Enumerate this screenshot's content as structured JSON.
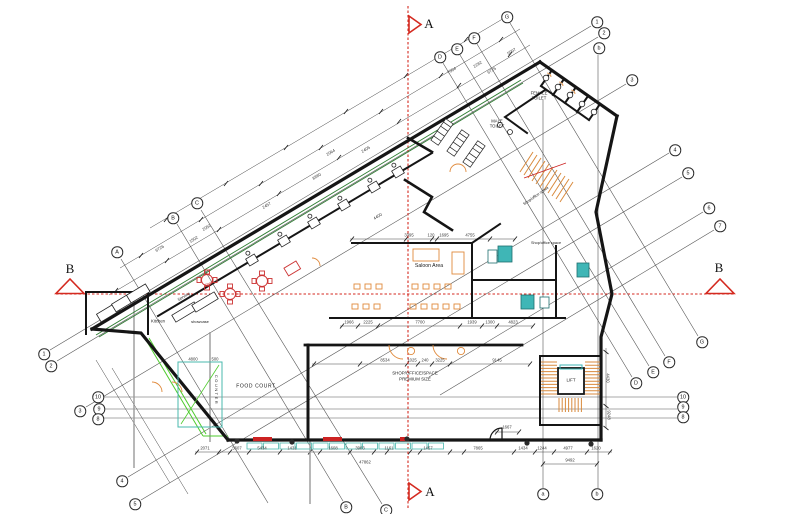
{
  "title": "architectural-floor-plan",
  "colors": {
    "section_red": "#d42a20",
    "glazing_green": "#2e7d32",
    "bright_green": "#4ecb2d",
    "counter_teal": "#4ab8ae",
    "teal_fixture": "#3fb6b6",
    "furniture_orange": "#e08a3c",
    "furniture_red": "#cc3333",
    "wall_black": "#151515"
  },
  "drawing": {
    "section_markers": [
      {
        "label": "A",
        "x": 429,
        "y": 24,
        "size": 13
      },
      {
        "label": "A",
        "x": 430,
        "y": 492,
        "size": 13
      },
      {
        "label": "B",
        "x": 70,
        "y": 269,
        "size": 13
      },
      {
        "label": "B",
        "x": 719,
        "y": 268,
        "size": 13
      }
    ],
    "bubbles": [
      {
        "label": "A",
        "x": 117,
        "y": 252
      },
      {
        "label": "B",
        "x": 173,
        "y": 218
      },
      {
        "label": "C",
        "x": 197,
        "y": 203
      },
      {
        "label": "D",
        "x": 440,
        "y": 57
      },
      {
        "label": "E",
        "x": 457,
        "y": 49
      },
      {
        "label": "F",
        "x": 474,
        "y": 38
      },
      {
        "label": "G",
        "x": 507,
        "y": 17
      },
      {
        "label": "1",
        "x": 597,
        "y": 22
      },
      {
        "label": "2",
        "x": 604,
        "y": 33
      },
      {
        "label": "b",
        "x": 599,
        "y": 48
      },
      {
        "label": "3",
        "x": 632,
        "y": 80
      },
      {
        "label": "4",
        "x": 675,
        "y": 150
      },
      {
        "label": "5",
        "x": 688,
        "y": 173
      },
      {
        "label": "6",
        "x": 709,
        "y": 208
      },
      {
        "label": "7",
        "x": 720,
        "y": 226
      },
      {
        "label": "D",
        "x": 636,
        "y": 383
      },
      {
        "label": "E",
        "x": 653,
        "y": 372
      },
      {
        "label": "F",
        "x": 669,
        "y": 362
      },
      {
        "label": "G",
        "x": 702,
        "y": 342
      },
      {
        "label": "10",
        "x": 683,
        "y": 397
      },
      {
        "label": "9",
        "x": 683,
        "y": 407
      },
      {
        "label": "8",
        "x": 683,
        "y": 417
      },
      {
        "label": "1",
        "x": 44,
        "y": 354
      },
      {
        "label": "2",
        "x": 51,
        "y": 366
      },
      {
        "label": "3",
        "x": 80,
        "y": 411
      },
      {
        "label": "10",
        "x": 98,
        "y": 397
      },
      {
        "label": "9",
        "x": 99,
        "y": 409
      },
      {
        "label": "8",
        "x": 98,
        "y": 419
      },
      {
        "label": "4",
        "x": 122,
        "y": 481
      },
      {
        "label": "5",
        "x": 135,
        "y": 504
      },
      {
        "label": "B",
        "x": 346,
        "y": 507
      },
      {
        "label": "C",
        "x": 386,
        "y": 510
      },
      {
        "label": "a",
        "x": 543,
        "y": 494
      },
      {
        "label": "b",
        "x": 597,
        "y": 494
      }
    ],
    "room_labels": [
      {
        "text": "FEMALE\nTOILET",
        "x": 539,
        "y": 96,
        "size": 4.2
      },
      {
        "text": "MALE\nTOILET",
        "x": 497,
        "y": 124,
        "size": 4.2
      },
      {
        "text": "Saloon Area",
        "x": 429,
        "y": 267,
        "size": 5.2
      },
      {
        "text": "Kitchen",
        "x": 158,
        "y": 322,
        "size": 4.2
      },
      {
        "text": "showcase",
        "x": 200,
        "y": 322,
        "size": 4
      },
      {
        "text": "Serving",
        "x": 184,
        "y": 297,
        "size": 4,
        "rot": -31
      },
      {
        "text": "Shop",
        "x": 209,
        "y": 284,
        "size": 4,
        "rot": -31,
        "color": "#cc3333"
      },
      {
        "text": "FOOD COURT",
        "x": 256,
        "y": 387,
        "size": 5,
        "ls": 0.6
      },
      {
        "text": "SHOP/OFFICE/SPACE",
        "x": 415,
        "y": 374,
        "size": 4.4
      },
      {
        "text": "PREMIUM SIZE",
        "x": 415,
        "y": 380,
        "size": 4.4
      },
      {
        "text": "LIFT",
        "x": 571,
        "y": 381,
        "size": 4.4
      },
      {
        "text": "COUNTER",
        "x": 216,
        "y": 390,
        "size": 4,
        "rot": 90,
        "ls": 1.5
      },
      {
        "text": "Shop/office space",
        "x": 536,
        "y": 196,
        "size": 3.8,
        "rot": -35
      },
      {
        "text": "Shop/office space",
        "x": 546,
        "y": 243,
        "size": 3.8
      }
    ],
    "dim_labels": [
      {
        "text": "6726",
        "x": 160,
        "y": 249,
        "rot": -31
      },
      {
        "text": "1502",
        "x": 194,
        "y": 240,
        "rot": -31
      },
      {
        "text": "2052",
        "x": 207,
        "y": 228,
        "rot": -31
      },
      {
        "text": "2457",
        "x": 267,
        "y": 206,
        "rot": -31
      },
      {
        "text": "8880",
        "x": 317,
        "y": 177,
        "rot": -31
      },
      {
        "text": "2064",
        "x": 331,
        "y": 153,
        "rot": -31
      },
      {
        "text": "2405",
        "x": 366,
        "y": 150,
        "rot": -31
      },
      {
        "text": "4400",
        "x": 378,
        "y": 217,
        "rot": -31
      },
      {
        "text": "7004",
        "x": 452,
        "y": 71,
        "rot": -31
      },
      {
        "text": "2282",
        "x": 478,
        "y": 65,
        "rot": -31
      },
      {
        "text": "6725",
        "x": 492,
        "y": 71,
        "rot": -31
      },
      {
        "text": "5997",
        "x": 512,
        "y": 52,
        "rot": -31
      },
      {
        "text": "3395",
        "x": 409,
        "y": 236
      },
      {
        "text": "120",
        "x": 431,
        "y": 236
      },
      {
        "text": "1695",
        "x": 444,
        "y": 236
      },
      {
        "text": "4755",
        "x": 470,
        "y": 236
      },
      {
        "text": "1966",
        "x": 349,
        "y": 323
      },
      {
        "text": "2225",
        "x": 368,
        "y": 323
      },
      {
        "text": "7700",
        "x": 420,
        "y": 323
      },
      {
        "text": "1939",
        "x": 472,
        "y": 323
      },
      {
        "text": "1300",
        "x": 490,
        "y": 323
      },
      {
        "text": "4823",
        "x": 513,
        "y": 323
      },
      {
        "text": "8534",
        "x": 385,
        "y": 361
      },
      {
        "text": "1025",
        "x": 412,
        "y": 361
      },
      {
        "text": "240",
        "x": 425,
        "y": 361
      },
      {
        "text": "3225",
        "x": 440,
        "y": 361
      },
      {
        "text": "9145",
        "x": 497,
        "y": 361
      },
      {
        "text": "4800",
        "x": 193,
        "y": 360
      },
      {
        "text": "500",
        "x": 215,
        "y": 360
      },
      {
        "text": "1667",
        "x": 507,
        "y": 428
      },
      {
        "text": "2071",
        "x": 205,
        "y": 449
      },
      {
        "text": "5607",
        "x": 237,
        "y": 449
      },
      {
        "text": "5434",
        "x": 262,
        "y": 449
      },
      {
        "text": "1431",
        "x": 292,
        "y": 449
      },
      {
        "text": "1608",
        "x": 333,
        "y": 449
      },
      {
        "text": "3903",
        "x": 360,
        "y": 449
      },
      {
        "text": "1161",
        "x": 389,
        "y": 449
      },
      {
        "text": "1457",
        "x": 428,
        "y": 449
      },
      {
        "text": "7865",
        "x": 478,
        "y": 449
      },
      {
        "text": "1434",
        "x": 523,
        "y": 449
      },
      {
        "text": "1244",
        "x": 542,
        "y": 449
      },
      {
        "text": "4977",
        "x": 568,
        "y": 449
      },
      {
        "text": "1620",
        "x": 596,
        "y": 449
      },
      {
        "text": "47862",
        "x": 365,
        "y": 463
      },
      {
        "text": "9492",
        "x": 570,
        "y": 461
      },
      {
        "text": "4430",
        "x": 607,
        "y": 378,
        "rot": 90
      },
      {
        "text": "9248",
        "x": 608,
        "y": 415,
        "rot": 90
      }
    ]
  }
}
